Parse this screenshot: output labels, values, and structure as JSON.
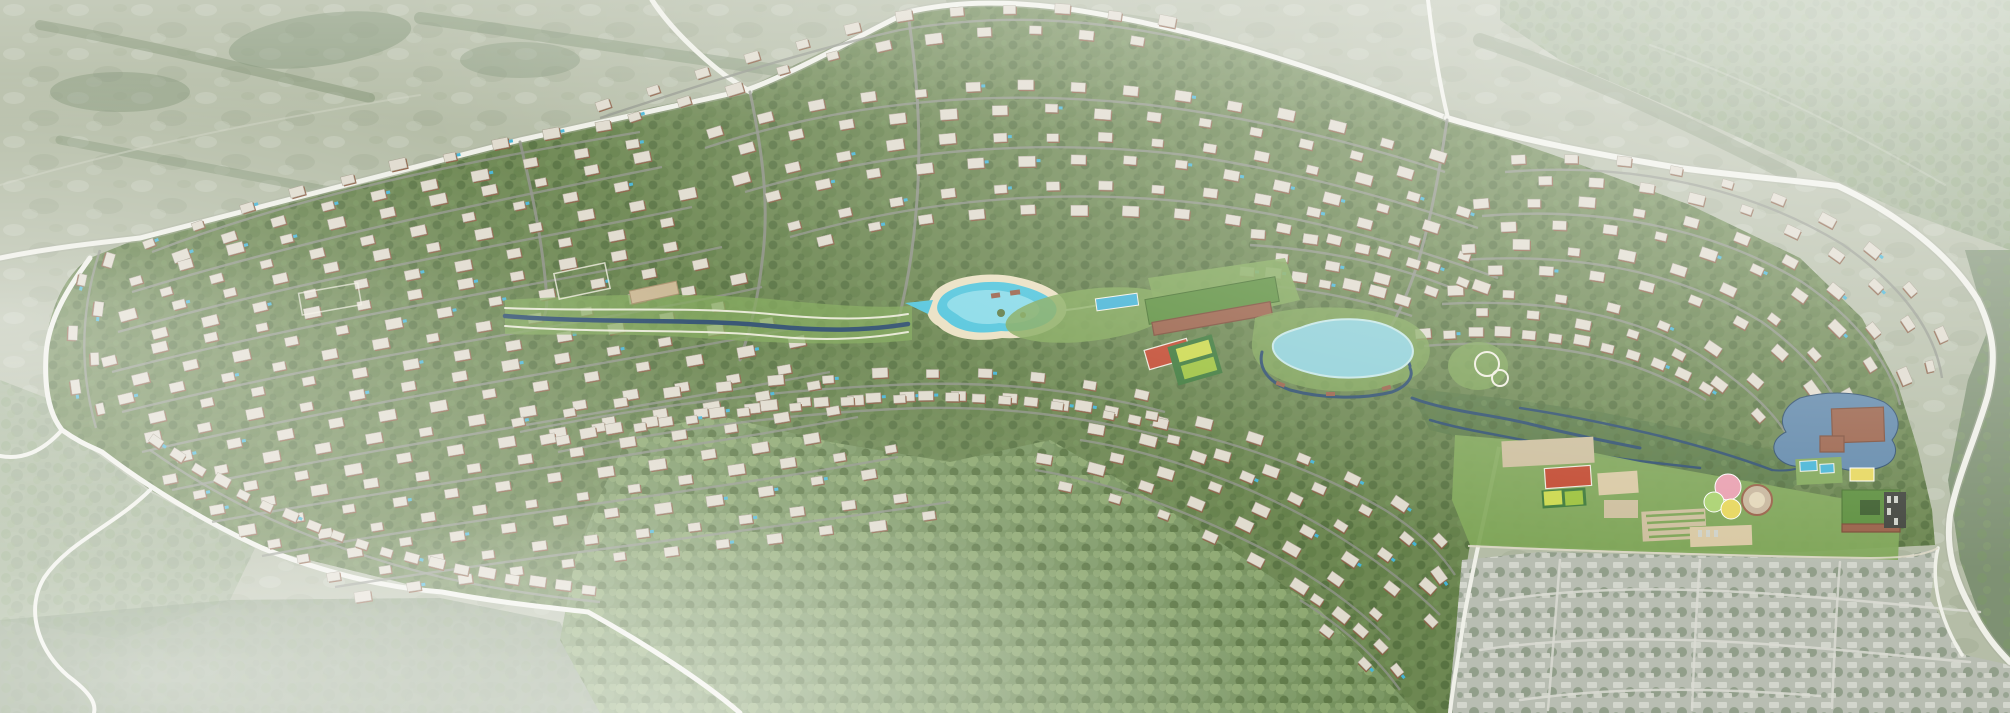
{
  "image": {
    "type": "aerial-masterplan-render",
    "title": "Aerial rendering of a hillside master-planned residential community with crystal lagoon, lake, clubhouse, amenity park, pine forest and surrounding fields"
  },
  "palette": {
    "field_base": "#b5bda7",
    "field_light": "#cfd4c3",
    "field_dark": "#9aa78b",
    "hedgerow": "#7b8e6e",
    "outer_forest": "#9aab8c",
    "outer_forest_dark": "#7e9173",
    "site_green": "#6d8752",
    "site_tree_dark": "#4f6a3b",
    "site_tree_mid": "#5f7c46",
    "site_tree_light": "#74935a",
    "lawn": "#82a85b",
    "forest_base": "#74905c",
    "forest_light": "#8da870",
    "forest_mid": "#7c9865",
    "forest_dark": "#57713f",
    "road_outer": "#eff0e8",
    "road_inner": "#90938a",
    "path_white": "#f2efe2",
    "creek": "#2f4f6e",
    "lake": "#8fd0d8",
    "lake_rim": "#c5e7e6",
    "lagoon": "#52c5dc",
    "lagoon_light": "#aee8f0",
    "sand": "#eae0c2",
    "pond": "#6188aa",
    "roof": "#e0dbce",
    "roof_stroke": "#a59e8e",
    "house_body": "#8d5f45",
    "pool": "#46b4d6",
    "grey_base": "#b8bdb2",
    "grey_roof": "#d4d7ce",
    "grey_tree": "#8f9c88",
    "grey_street": "#d9dbd2",
    "club_roof": "#5e9040",
    "brick": "#9a624a",
    "brick_dark": "#7c4c38",
    "court_red": "#c24a31",
    "court_base": "#3f7a3c",
    "court_lime": "#ccd94e",
    "court_green": "#9dc23e",
    "circle_pink": "#e9a0b0",
    "circle_yellow": "#e7d75e",
    "circle_green": "#abd271",
    "dirt": "#cdbf9e",
    "dirt_light": "#d9c9a4",
    "parking_dark": "#43463f"
  },
  "houses": {
    "spacing": 26,
    "width": 14,
    "height": 9,
    "offset": 9,
    "jitter": 5,
    "pool_chance": 0.22
  },
  "scene": {
    "regions": [
      {
        "name": "surrounding-fields",
        "desc": "hazy pale green farmland with hedgerows and tree belts around the site"
      },
      {
        "name": "community-site",
        "desc": "hillside development of terracotta houses with light roofs along curving contour streets among dense trees"
      },
      {
        "name": "crystal-lagoon",
        "desc": "turquoise kidney-shaped lagoon with sandy beach and timber decks"
      },
      {
        "name": "linear-park",
        "desc": "landscaped creek corridor with white walking paths and terraced gardens"
      },
      {
        "name": "central-lake",
        "desc": "pale blue lake ringed by a dark creek channel with timber bridges"
      },
      {
        "name": "clubhouse",
        "desc": "long green-roofed clubhouse with brick terraces and swimming pool"
      },
      {
        "name": "sports-courts",
        "desc": "red basketball court and lime tennis courts"
      },
      {
        "name": "wetland-park",
        "desc": "marsh park with winding dark blue channels, pond and brick pavilion"
      },
      {
        "name": "amenity-strip",
        "desc": "sports field, playgrounds, splash-pad circles, allotment gardens, pools, green-roof school and dark parking lot"
      },
      {
        "name": "pine-forest",
        "desc": "large preserved pine forest wedge at bottom centre"
      },
      {
        "name": "grey-neighborhood",
        "desc": "existing desaturated grey housing tract at bottom right"
      },
      {
        "name": "boundary-roads",
        "desc": "white perimeter roads and highway curving along the right edge"
      }
    ]
  }
}
